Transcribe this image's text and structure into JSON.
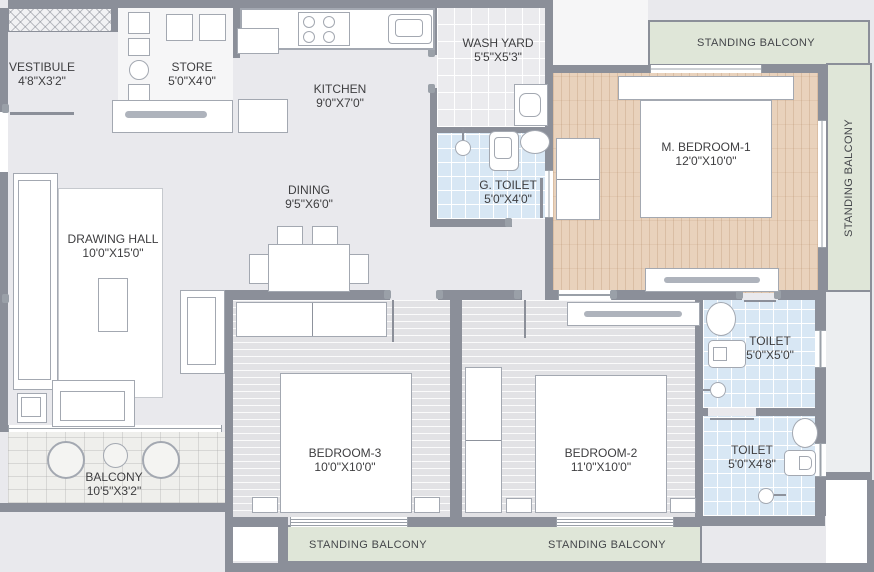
{
  "title": "Apartment floor plan",
  "colors": {
    "background": "#e9e9ed",
    "wall": "#8b8f99",
    "balcony_green": "#dfe6d8",
    "master_bedroom_wood": "#e9d2bc",
    "toilet_tile_blue": "#d8e7f4",
    "bedroom_floor": "#e2e2e5",
    "furniture_outline": "#a3a8b1",
    "label_text": "#3e3e40"
  },
  "furniture_icons": [
    "sofa",
    "coffee-table",
    "armchair",
    "rug",
    "dining-table",
    "dining-chair",
    "kitchen-counter",
    "stove",
    "sink",
    "refrigerator",
    "cabinet",
    "store-shelves",
    "washing-machine",
    "shower",
    "wc",
    "washbasin",
    "bed",
    "wardrobe",
    "dresser",
    "round-chair",
    "round-table"
  ],
  "plan": {
    "vestibule": {
      "name": "VESTIBULE",
      "dims": "4'8\"X3'2\""
    },
    "store": {
      "name": "STORE",
      "dims": "5'0\"X4'0\""
    },
    "kitchen": {
      "name": "KITCHEN",
      "dims": "9'0\"X7'0\""
    },
    "wash_yard": {
      "name": "WASH YARD",
      "dims": "5'5\"X5'3\""
    },
    "g_toilet": {
      "name": "G. TOILET",
      "dims": "5'0\"X4'0\""
    },
    "dining": {
      "name": "DINING",
      "dims": "9'5\"X6'0\""
    },
    "drawing_hall": {
      "name": "DRAWING HALL",
      "dims": "10'0\"X15'0\""
    },
    "m_bedroom_1": {
      "name": "M. BEDROOM-1",
      "dims": "12'0\"X10'0\""
    },
    "bedroom_2": {
      "name": "BEDROOM-2",
      "dims": "11'0\"X10'0\""
    },
    "bedroom_3": {
      "name": "BEDROOM-3",
      "dims": "10'0\"X10'0\""
    },
    "toilet_master": {
      "name": "TOILET",
      "dims": "5'0\"X5'0\""
    },
    "toilet_common": {
      "name": "TOILET",
      "dims": "5'0\"X4'8\""
    },
    "balcony": {
      "name": "BALCONY",
      "dims": "10'5\"X3'2\""
    },
    "standing_balcony_top": {
      "name": "STANDING BALCONY"
    },
    "standing_balcony_right": {
      "name": "STANDING BALCONY"
    },
    "standing_balcony_bottom_left": {
      "name": "STANDING BALCONY"
    },
    "standing_balcony_bottom_right": {
      "name": "STANDING BALCONY"
    }
  }
}
